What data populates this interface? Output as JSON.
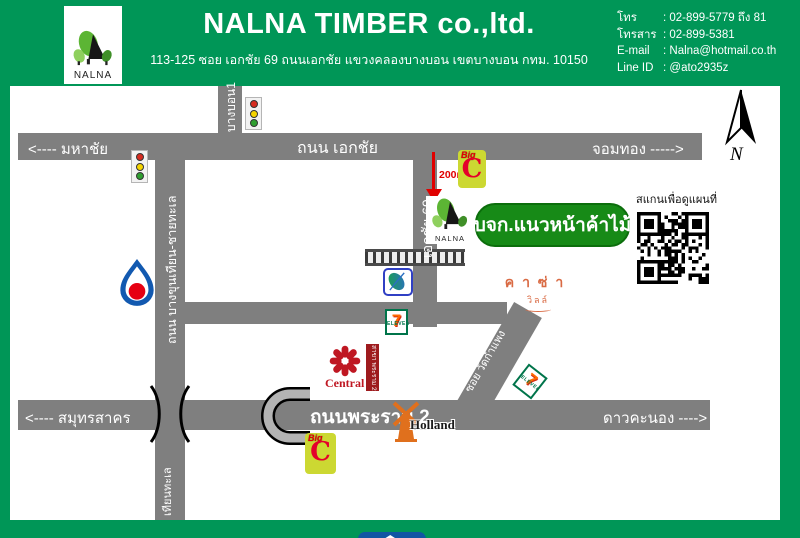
{
  "header": {
    "logo_text": "NALNA",
    "company": "NALNA TIMBER co.,ltd.",
    "address": "113-125 ซอย เอกชัย 69 ถนนเอกชัย แขวงคลองบางบอน เขตบางบอน กทม. 10150",
    "contacts": [
      {
        "label": "โทร",
        "value": ": 02-899-5779 ถึง 81"
      },
      {
        "label": "โทรสาร",
        "value": ":  02-899-5381"
      },
      {
        "label": "E-mail",
        "value": ": Nalna@hotmail.co.th"
      },
      {
        "label": "Line ID",
        "value": ": @ato2935z"
      }
    ]
  },
  "map": {
    "roads": {
      "ekachai": {
        "left": "<---- มหาชัย",
        "center": "ถนน เอกชัย",
        "right": "จอมทอง ----->"
      },
      "bangbon1": "บางบอน1",
      "bangkhunthian": "ถนน บางขุนเทียน-ชายทะเล",
      "thianthale": "เทียนทะเล",
      "ekachai69": "เอกชัย 69",
      "watkamphaeng": "ซอย วัดกำแพง",
      "rama2": {
        "left": "<---- สมุทรสาคร",
        "center": "ถนนพระราม 2",
        "right": "ดาวคะนอง ---->"
      }
    },
    "company_box_label": "บจก.แนวหน้าค้าไม้",
    "distance_label": "200m.",
    "qr_caption": "สแกนเพื่อดูแผนที่",
    "compass_label": "N",
    "nalna_logo_label": "NALNA",
    "landmarks": {
      "casa_line1": "คาซ่า",
      "casa_line2": "วิลล์",
      "central_name": "Central",
      "central_branch": "สาขา พระราม 2",
      "holland": "Holland",
      "homepro_home": "Home",
      "homepro_pro": "Pro",
      "bigc_big": "Big",
      "bigc_c": "C",
      "seven_numeral": "7",
      "seven_eleven": "ELEVEn"
    },
    "colors": {
      "header_green": "#009657",
      "road_gray": "#7f7f7f",
      "company_box_green": "#178a17",
      "bigc_yellow": "#ccd832",
      "bigc_red": "#e4002b",
      "seven_green": "#00744a",
      "seven_orange": "#ff6a00",
      "homepro_blue": "#1156a3",
      "homepro_orange": "#f7941d",
      "central_red": "#bf1722",
      "casa_orange": "#d96a43",
      "ptt_blue": "#1259b0",
      "ptt_red": "#e60012",
      "lotus_blue": "#3040c4",
      "arrow_red": "#e00000"
    }
  }
}
